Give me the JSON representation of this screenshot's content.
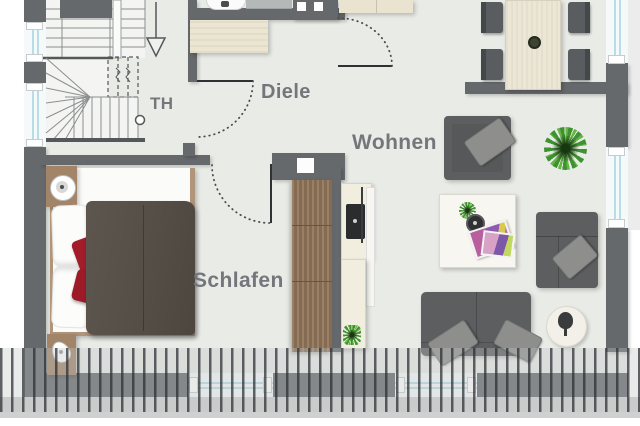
{
  "rooms": {
    "th": {
      "label": "TH"
    },
    "diele": {
      "label": "Diele"
    },
    "wohnen": {
      "label": "Wohnen"
    },
    "schlafen": {
      "label": "Schlafen"
    }
  },
  "symbols": [
    "staircase-icon",
    "stair-direction-arrow-icon",
    "entry-door-swing-icon",
    "bedroom-door-swing-icon",
    "livingroom-door-swing-icon",
    "toilet-icon",
    "washbasin-icon",
    "sideboard-icon",
    "wardrobe-cabinet-icon",
    "kitchenette-icon",
    "cooktop-icon",
    "dining-table-icon",
    "dining-chair-icon",
    "armchair-icon",
    "plant-icon",
    "corner-sofa-icon",
    "coffee-table-icon",
    "magazines-icon",
    "sofa-icon",
    "rug-icon",
    "bed-icon",
    "nightstand-icon",
    "bed-lamp-icon",
    "pillow-icon",
    "red-cushion-icon",
    "duvet-icon",
    "balcony-railing-icon",
    "window-icon"
  ],
  "colors": {
    "wall": "#65696c",
    "floor": "#e9ebe7",
    "stair_floor": "#f4f5f3",
    "wood_dark": "#8f7358",
    "wood_light": "#a28568",
    "sideboard_beige": "#ebe5d2",
    "table_cream": "#ece7d5",
    "sofa_gray": "#5c5e60",
    "cushion_gray": "#8e8e8c",
    "accent_red": "#a31c2a",
    "duvet_brown": "#585149",
    "plant_green": "#3e9330",
    "window_glass": "#b8dde6",
    "label_text": "#73777b",
    "railing_gray": "#3a3e41"
  }
}
